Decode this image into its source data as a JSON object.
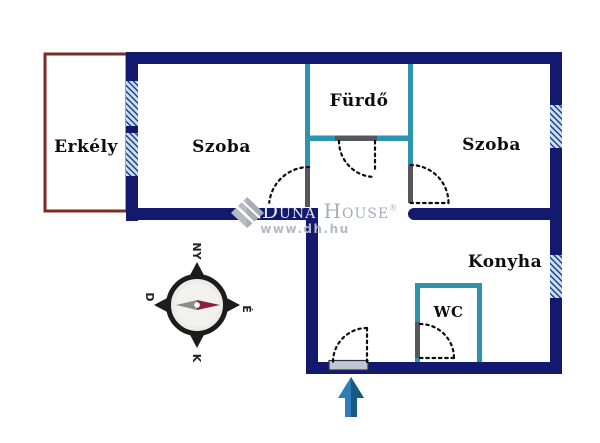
{
  "floorplan": {
    "rooms": {
      "balcony": "Erkély",
      "room_left": "Szoba",
      "bathroom": "Fürdő",
      "room_right": "Szoba",
      "kitchen": "Konyha",
      "wc": "WC"
    },
    "compass": {
      "west": "NY",
      "south": "D",
      "north": "É",
      "east": "K"
    },
    "watermark": {
      "brand_first": "Duna",
      "brand_second": "House",
      "reg": "®",
      "url": "www.dh.hu"
    },
    "colors": {
      "outer_wall": "#131a6e",
      "partition_wall": "#2e93ae",
      "door_jamb": "#54585c",
      "window_fill": "#c3e0ef",
      "balcony_border": "#7d2b26",
      "entrance_arrow": "#2e7cb8",
      "compass_needle_north": "#8c1f3c"
    }
  }
}
